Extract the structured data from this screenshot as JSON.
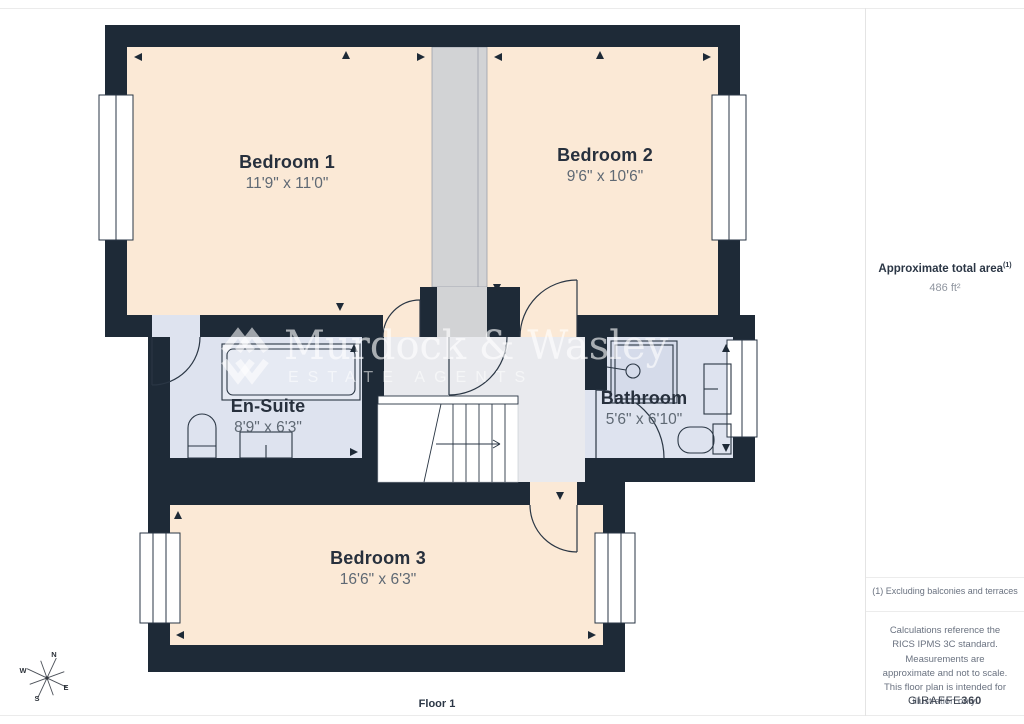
{
  "rooms": [
    {
      "name": "Bedroom 1",
      "dims": "11'9\" x 11'0\""
    },
    {
      "name": "Bedroom 2",
      "dims": "9'6\" x 10'6\""
    },
    {
      "name": "En-Suite",
      "dims": "8'9\" x 6'3\""
    },
    {
      "name": "Bathroom",
      "dims": "5'6\" x 6'10\""
    },
    {
      "name": "Bedroom 3",
      "dims": "16'6\" x 6'3\""
    }
  ],
  "floor_label": "Floor 1",
  "watermark": {
    "line1": "Murdock & Wasley",
    "line2": "ESTATE AGENTS"
  },
  "compass": {
    "n": "N",
    "e": "E",
    "s": "S",
    "w": "W"
  },
  "sidebar": {
    "area_title": "Approximate total area",
    "area_superscript": "(1)",
    "area_value": "486 ft²",
    "footnote": "(1) Excluding balconies and terraces",
    "disclaimer": "Calculations reference the RICS IPMS 3C standard. Measurements are approximate and not to scale. This floor plan is intended for illustration only.",
    "brand": "GIRAFFE",
    "brand_bold": "360"
  },
  "colors": {
    "wall": "#1e2a37",
    "bedroom_fill": "#fbe9d6",
    "bathroom_fill": "#dee3ef",
    "landing_fill": "#e9eaee",
    "stairwell_fill": "#d2d3d5",
    "name_text": "#27303d",
    "dims_text": "#5f6974"
  }
}
